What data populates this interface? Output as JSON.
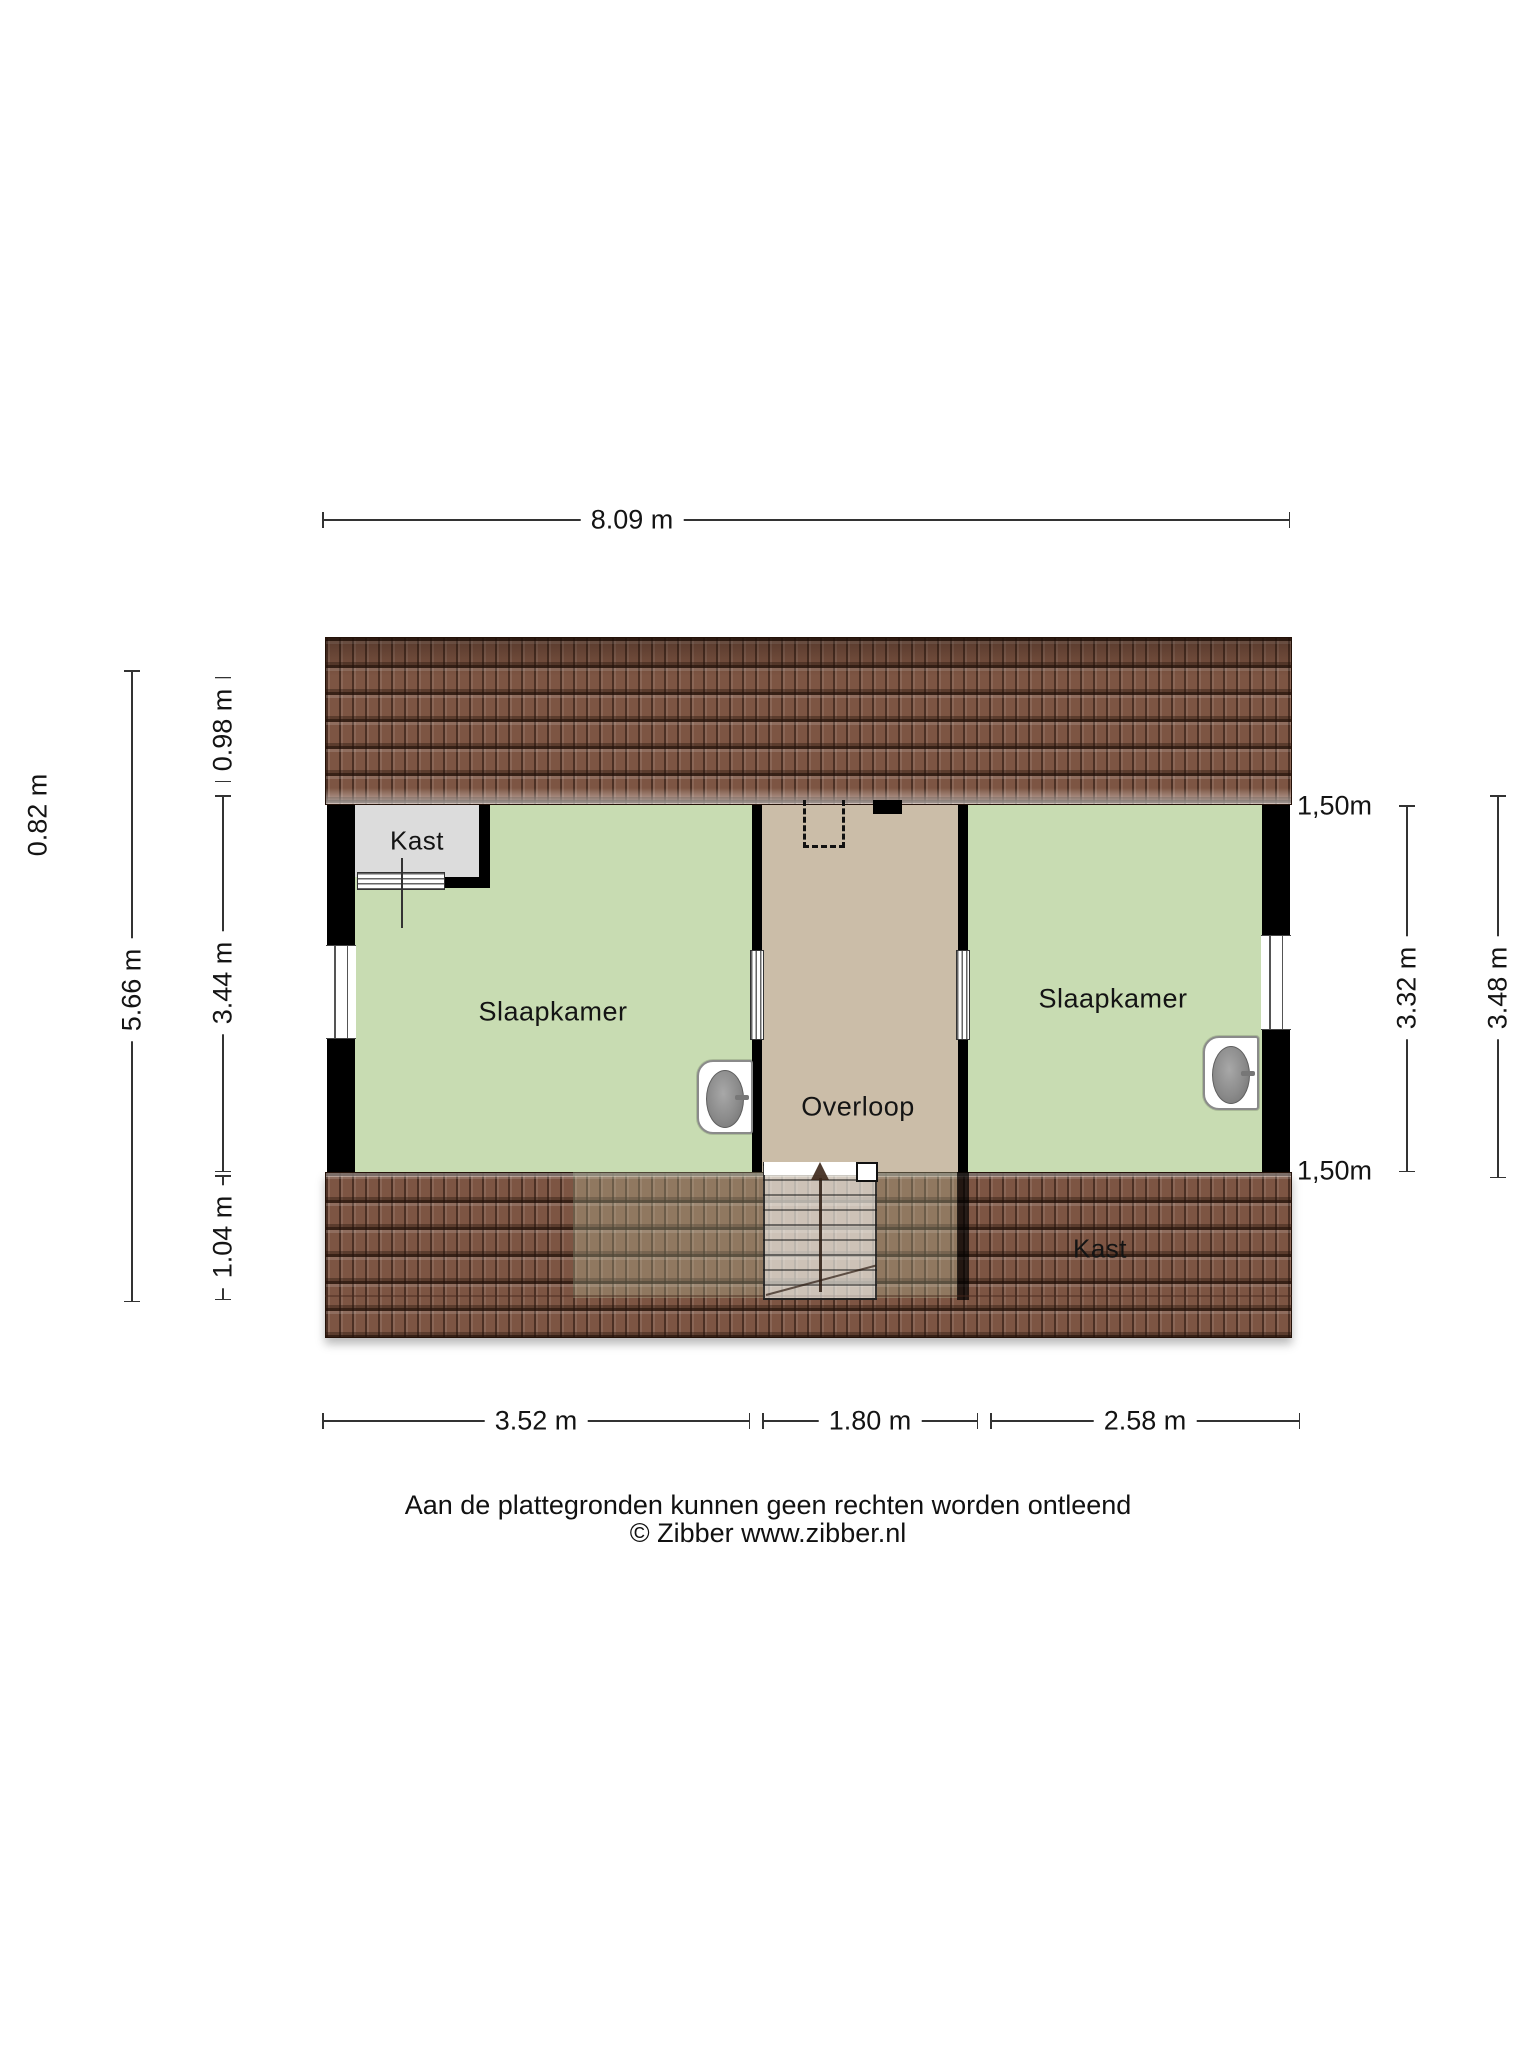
{
  "plan": {
    "rooms": {
      "closet_top_left": "Kast",
      "bedroom_left": "Slaapkamer",
      "hallway": "Overloop",
      "bedroom_right": "Slaapkamer",
      "closet_bottom_right": "Kast"
    },
    "dimensions": {
      "top_width": "8.09 m",
      "left_outer": "0.82 m",
      "left_total": "5.66 m",
      "left_top": "0.98 m",
      "left_middle": "3.44 m",
      "left_bottom": "1.04 m",
      "right_headroom_top": "1,50m",
      "right_headroom_bottom": "1,50m",
      "right_inner": "3.32 m",
      "right_outer": "3.48 m",
      "bottom_left": "3.52 m",
      "bottom_middle": "1.80 m",
      "bottom_right": "2.58 m"
    },
    "footer": {
      "disclaimer": "Aan de plattegronden kunnen geen rechten worden ontleend",
      "copyright": "© Zibber www.zibber.nl"
    },
    "colors": {
      "bedroom_green": "#c8dcb2",
      "hallway_tan": "#cbbda8",
      "closet_gray": "#dcdcdc",
      "roof_brown": "#7d5543",
      "wall_black": "#000000"
    }
  }
}
